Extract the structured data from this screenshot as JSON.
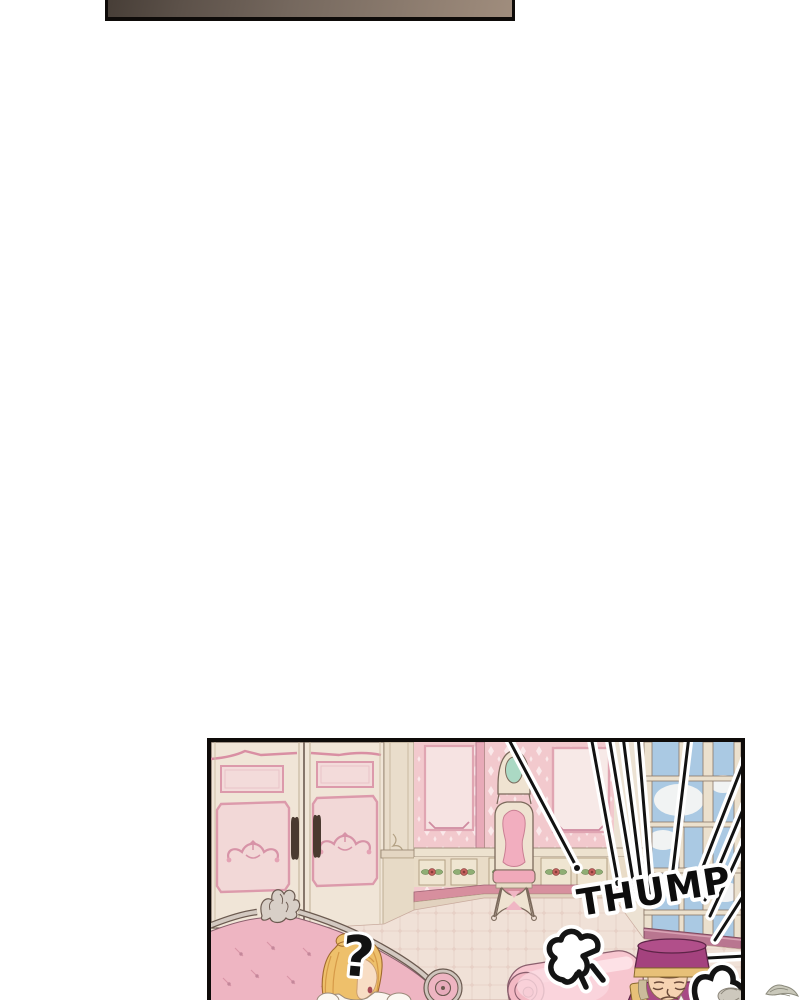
{
  "page": {
    "background": "#ffffff",
    "kind": "webtoon comic page, mostly blank with two panels"
  },
  "top_panel": {
    "description": "dark blank transition panel clipped by top edge",
    "border": "#0e0b09",
    "fill_left": "#473e37",
    "fill_mid": "#75685e",
    "fill_right": "#a08d7d"
  },
  "scene": {
    "description": "pink rococo palace room: wardrobe, vanity chair, windows; blonde woman on tufted couch with question mark; elderly attendant in pillbox cap bowing behind pink bedroll; THUMP sound effect with focus lines",
    "border": "#0e0b09",
    "sfx": {
      "thump": "THUMP",
      "question_mark": "?"
    },
    "palette": {
      "wall_cream": "#ece2d3",
      "wardrobe_cream": "#f0e5d7",
      "wallpaper_pink": "#f2c9cd",
      "wallpaper_motif": "#fae9ea",
      "trim_pink": "#dc9aab",
      "panel_inset_pink": "#f6e3e2",
      "wainscot": "#e9dcc7",
      "baseboard_pink": "#d78f9e",
      "floor": "#f0e1d7",
      "sky": "#aac9e3",
      "cloud": "#f5f6f4",
      "window_frame": "#ebe0cd",
      "sill_mauve": "#b97690",
      "mirror_green": "#abd9c4",
      "chair_pink": "#f2aebf",
      "couch_pink": "#eeb5c2",
      "frame_silver": "#d3c9c1",
      "roll_pink": "#f7c6cf",
      "hair_gold": "#eec06b",
      "skin": "#f8ddc4",
      "cap_magenta": "#a4427e",
      "uniform_magenta": "#a84a85",
      "gold_trim": "#e7c078",
      "ink": "#121212",
      "outline_brown": "#6b5a50"
    }
  }
}
